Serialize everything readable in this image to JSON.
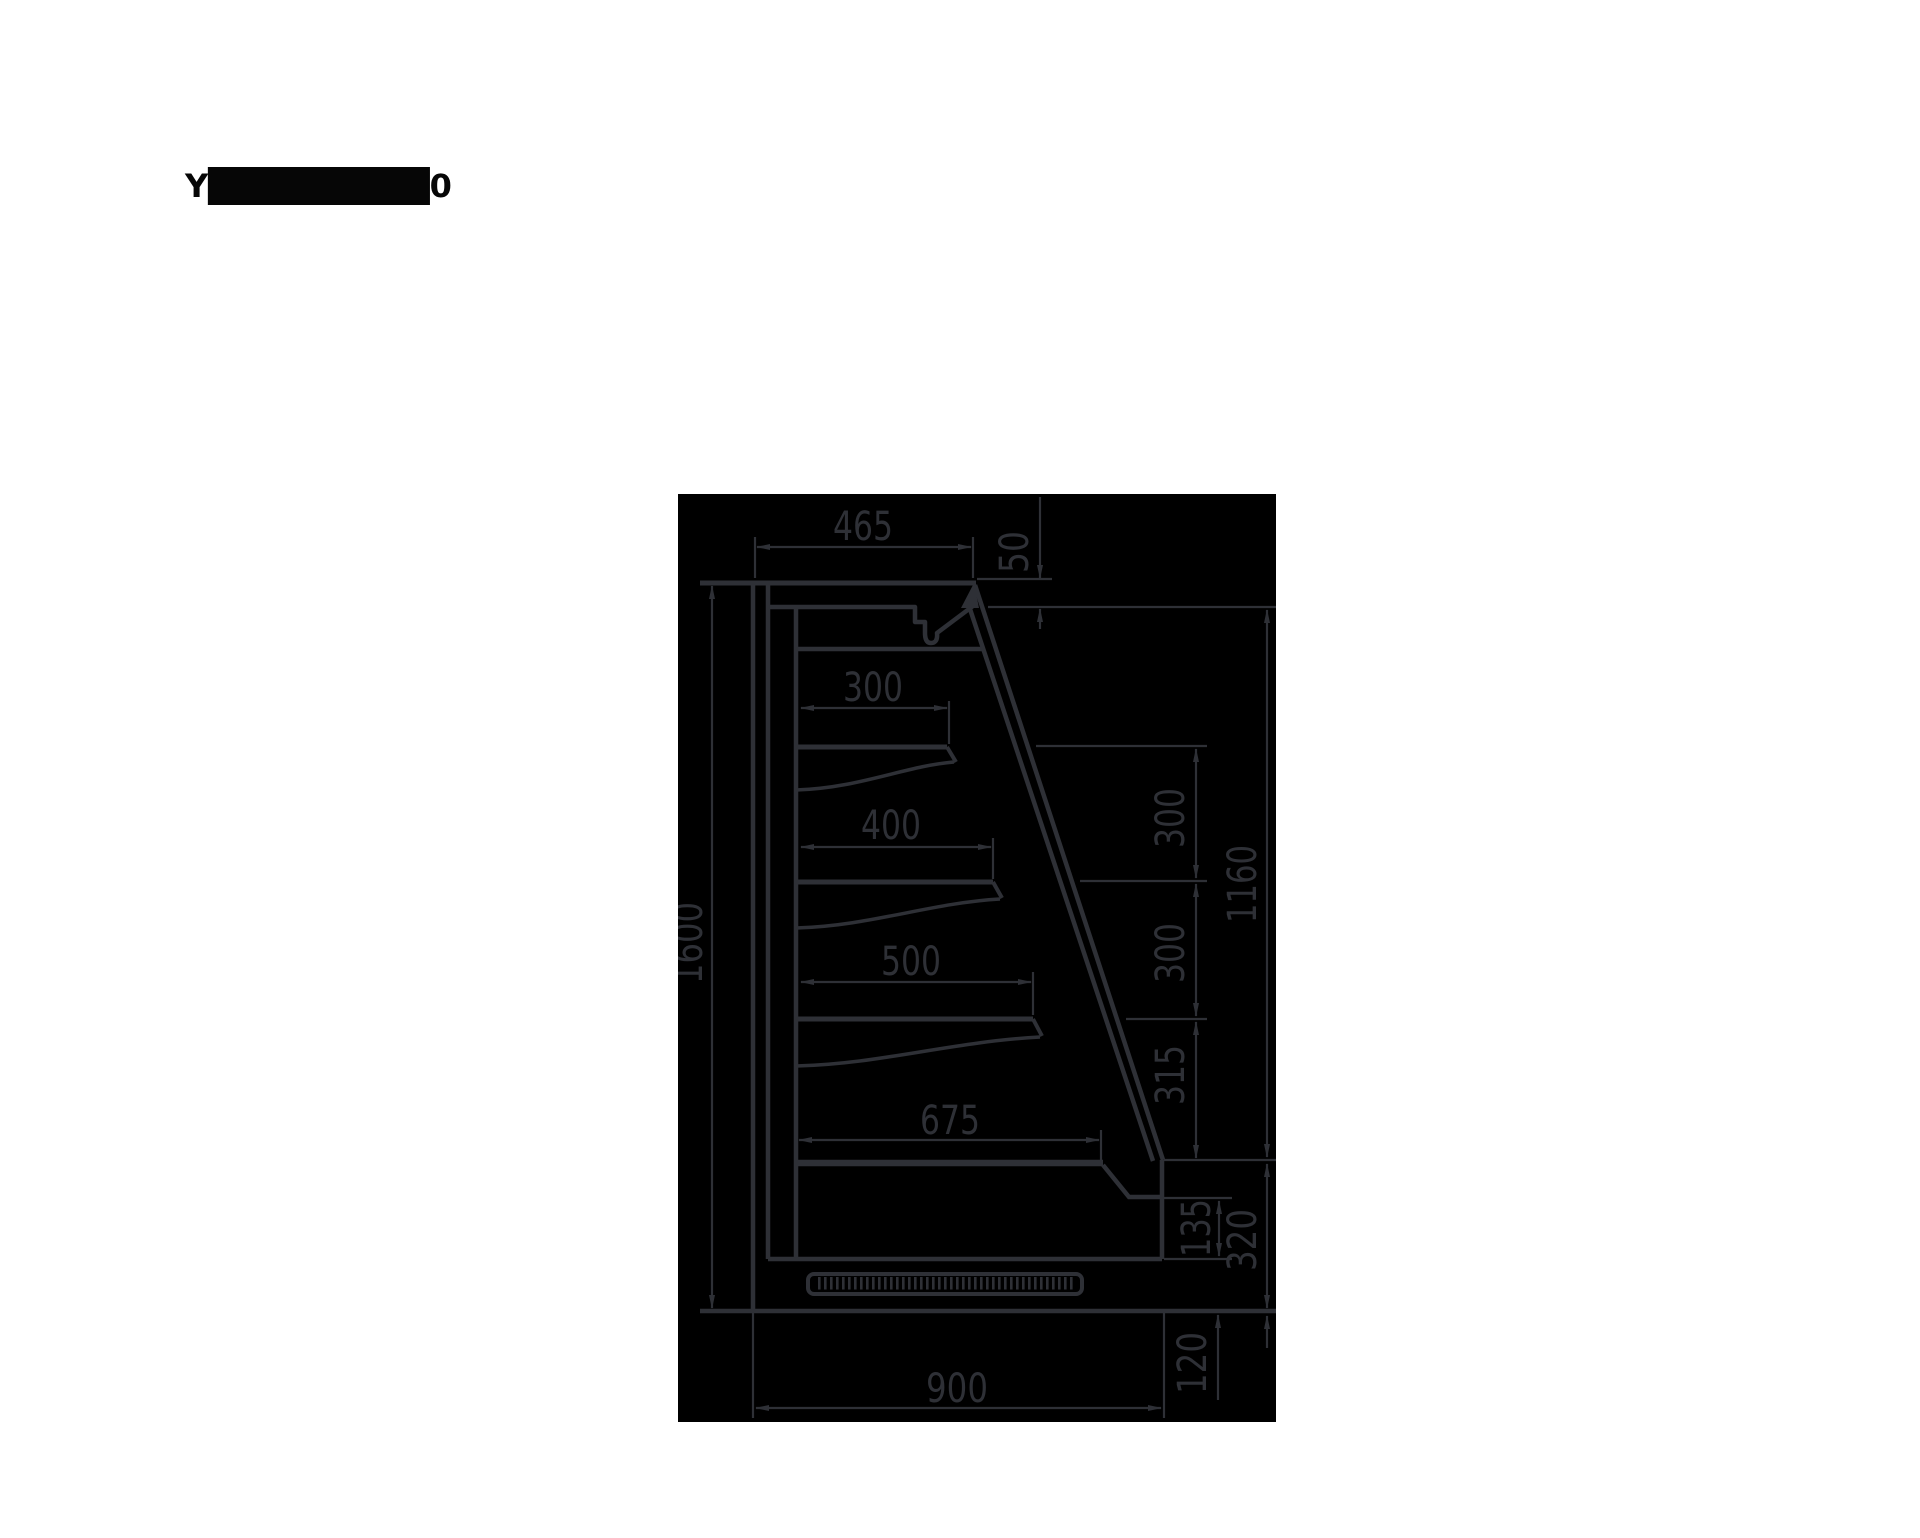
{
  "page": {
    "background": "#ffffff",
    "title": "Y█████████0"
  },
  "drawing": {
    "background": "#000000",
    "line_color": "#2e3036",
    "description_names": {
      "type": "side-section-technical-drawing"
    },
    "dimensions": {
      "top_depth": "465",
      "canopy_drop": "50",
      "overall_height": "1600",
      "shelf1_depth": "300",
      "shelf2_depth": "400",
      "shelf3_depth": "500",
      "deck_depth": "675",
      "shelf_gap_upper": "300",
      "shelf_gap_lower": "300",
      "front_opening_height": "1160",
      "deck_to_shelf": "315",
      "bumper_height": "135",
      "deck_height": "320",
      "plinth_height": "120",
      "overall_depth": "900"
    }
  }
}
